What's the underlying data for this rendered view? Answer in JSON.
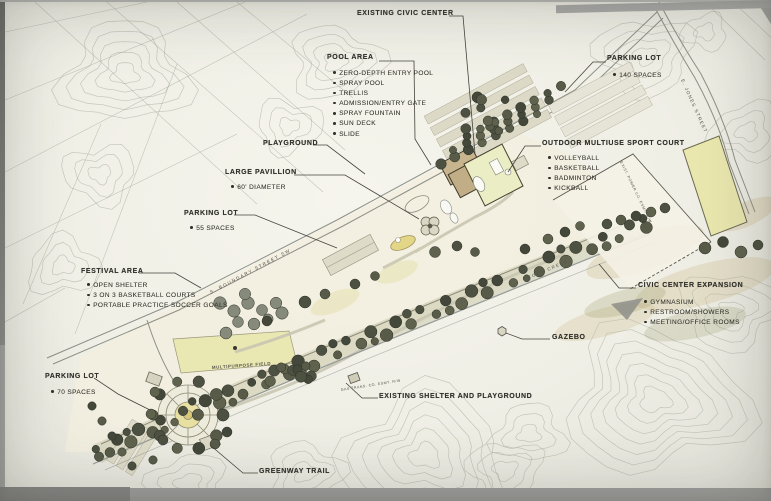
{
  "plan": {
    "callouts": [
      {
        "id": "existing-civic-center",
        "title": "EXISTING CIVIC CENTER",
        "items": []
      },
      {
        "id": "pool-area",
        "title": "POOL AREA",
        "items": [
          "ZERO-DEPTH ENTRY POOL",
          "SPRAY POOL",
          "TRELLIS",
          "ADMISSION/ENTRY GATE",
          "SPRAY FOUNTAIN",
          "SUN DECK",
          "SLIDE"
        ]
      },
      {
        "id": "parking-lot-north",
        "title": "PARKING LOT",
        "items": [
          "140 SPACES"
        ]
      },
      {
        "id": "outdoor-multiuse-sport-court",
        "title": "OUTDOOR MULTIUSE SPORT COURT",
        "items": [
          "VOLLEYBALL",
          "BASKETBALL",
          "BADMINTON",
          "KICKBALL"
        ]
      },
      {
        "id": "playground",
        "title": "PLAYGROUND",
        "items": []
      },
      {
        "id": "large-pavillion",
        "title": "LARGE PAVILLION",
        "items": [
          "60' DIAMETER"
        ]
      },
      {
        "id": "parking-lot-central",
        "title": "PARKING LOT",
        "items": [
          "55 SPACES"
        ]
      },
      {
        "id": "festival-area",
        "title": "FESTIVAL AREA",
        "items": [
          "OPEN SHELTER",
          "3 ON 3 BASKETBALL COURTS",
          "PORTABLE PRACTICE SOCCER GOALS"
        ]
      },
      {
        "id": "parking-lot-west",
        "title": "PARKING LOT",
        "items": [
          "70 SPACES"
        ]
      },
      {
        "id": "civic-center-expansion",
        "title": "CIVIC CENTER EXPANSION",
        "items": [
          "GYMNASIUM",
          "RESTROOM/SHOWERS",
          "MEETING/OFFICE ROOMS"
        ]
      },
      {
        "id": "gazebo",
        "title": "GAZEBO",
        "items": []
      },
      {
        "id": "existing-shelter-and-playground",
        "title": "EXISTING SHELTER AND PLAYGROUND",
        "items": []
      },
      {
        "id": "greenway-trail",
        "title": "GREENWAY TRAIL",
        "items": []
      }
    ],
    "small_labels": {
      "multipurpose_field": "MULTIPURPOSE FIELD",
      "boundary_street": "S. BOUNDARY STREET SW",
      "jones_street": "E. JONES STREET",
      "toms_creek": "TOMS CREEK",
      "power_easement": "EXIST. POWER CO. ESMT. R/W",
      "gas_easement": "GAS TRANS. CO. ESMT. R/W"
    },
    "colors": {
      "ink": "#32312b",
      "contour": "#b6b9ae",
      "tree_dark": "#4d5142",
      "lawn": "#e7e5ae",
      "paper": "#f2f1e8"
    }
  }
}
